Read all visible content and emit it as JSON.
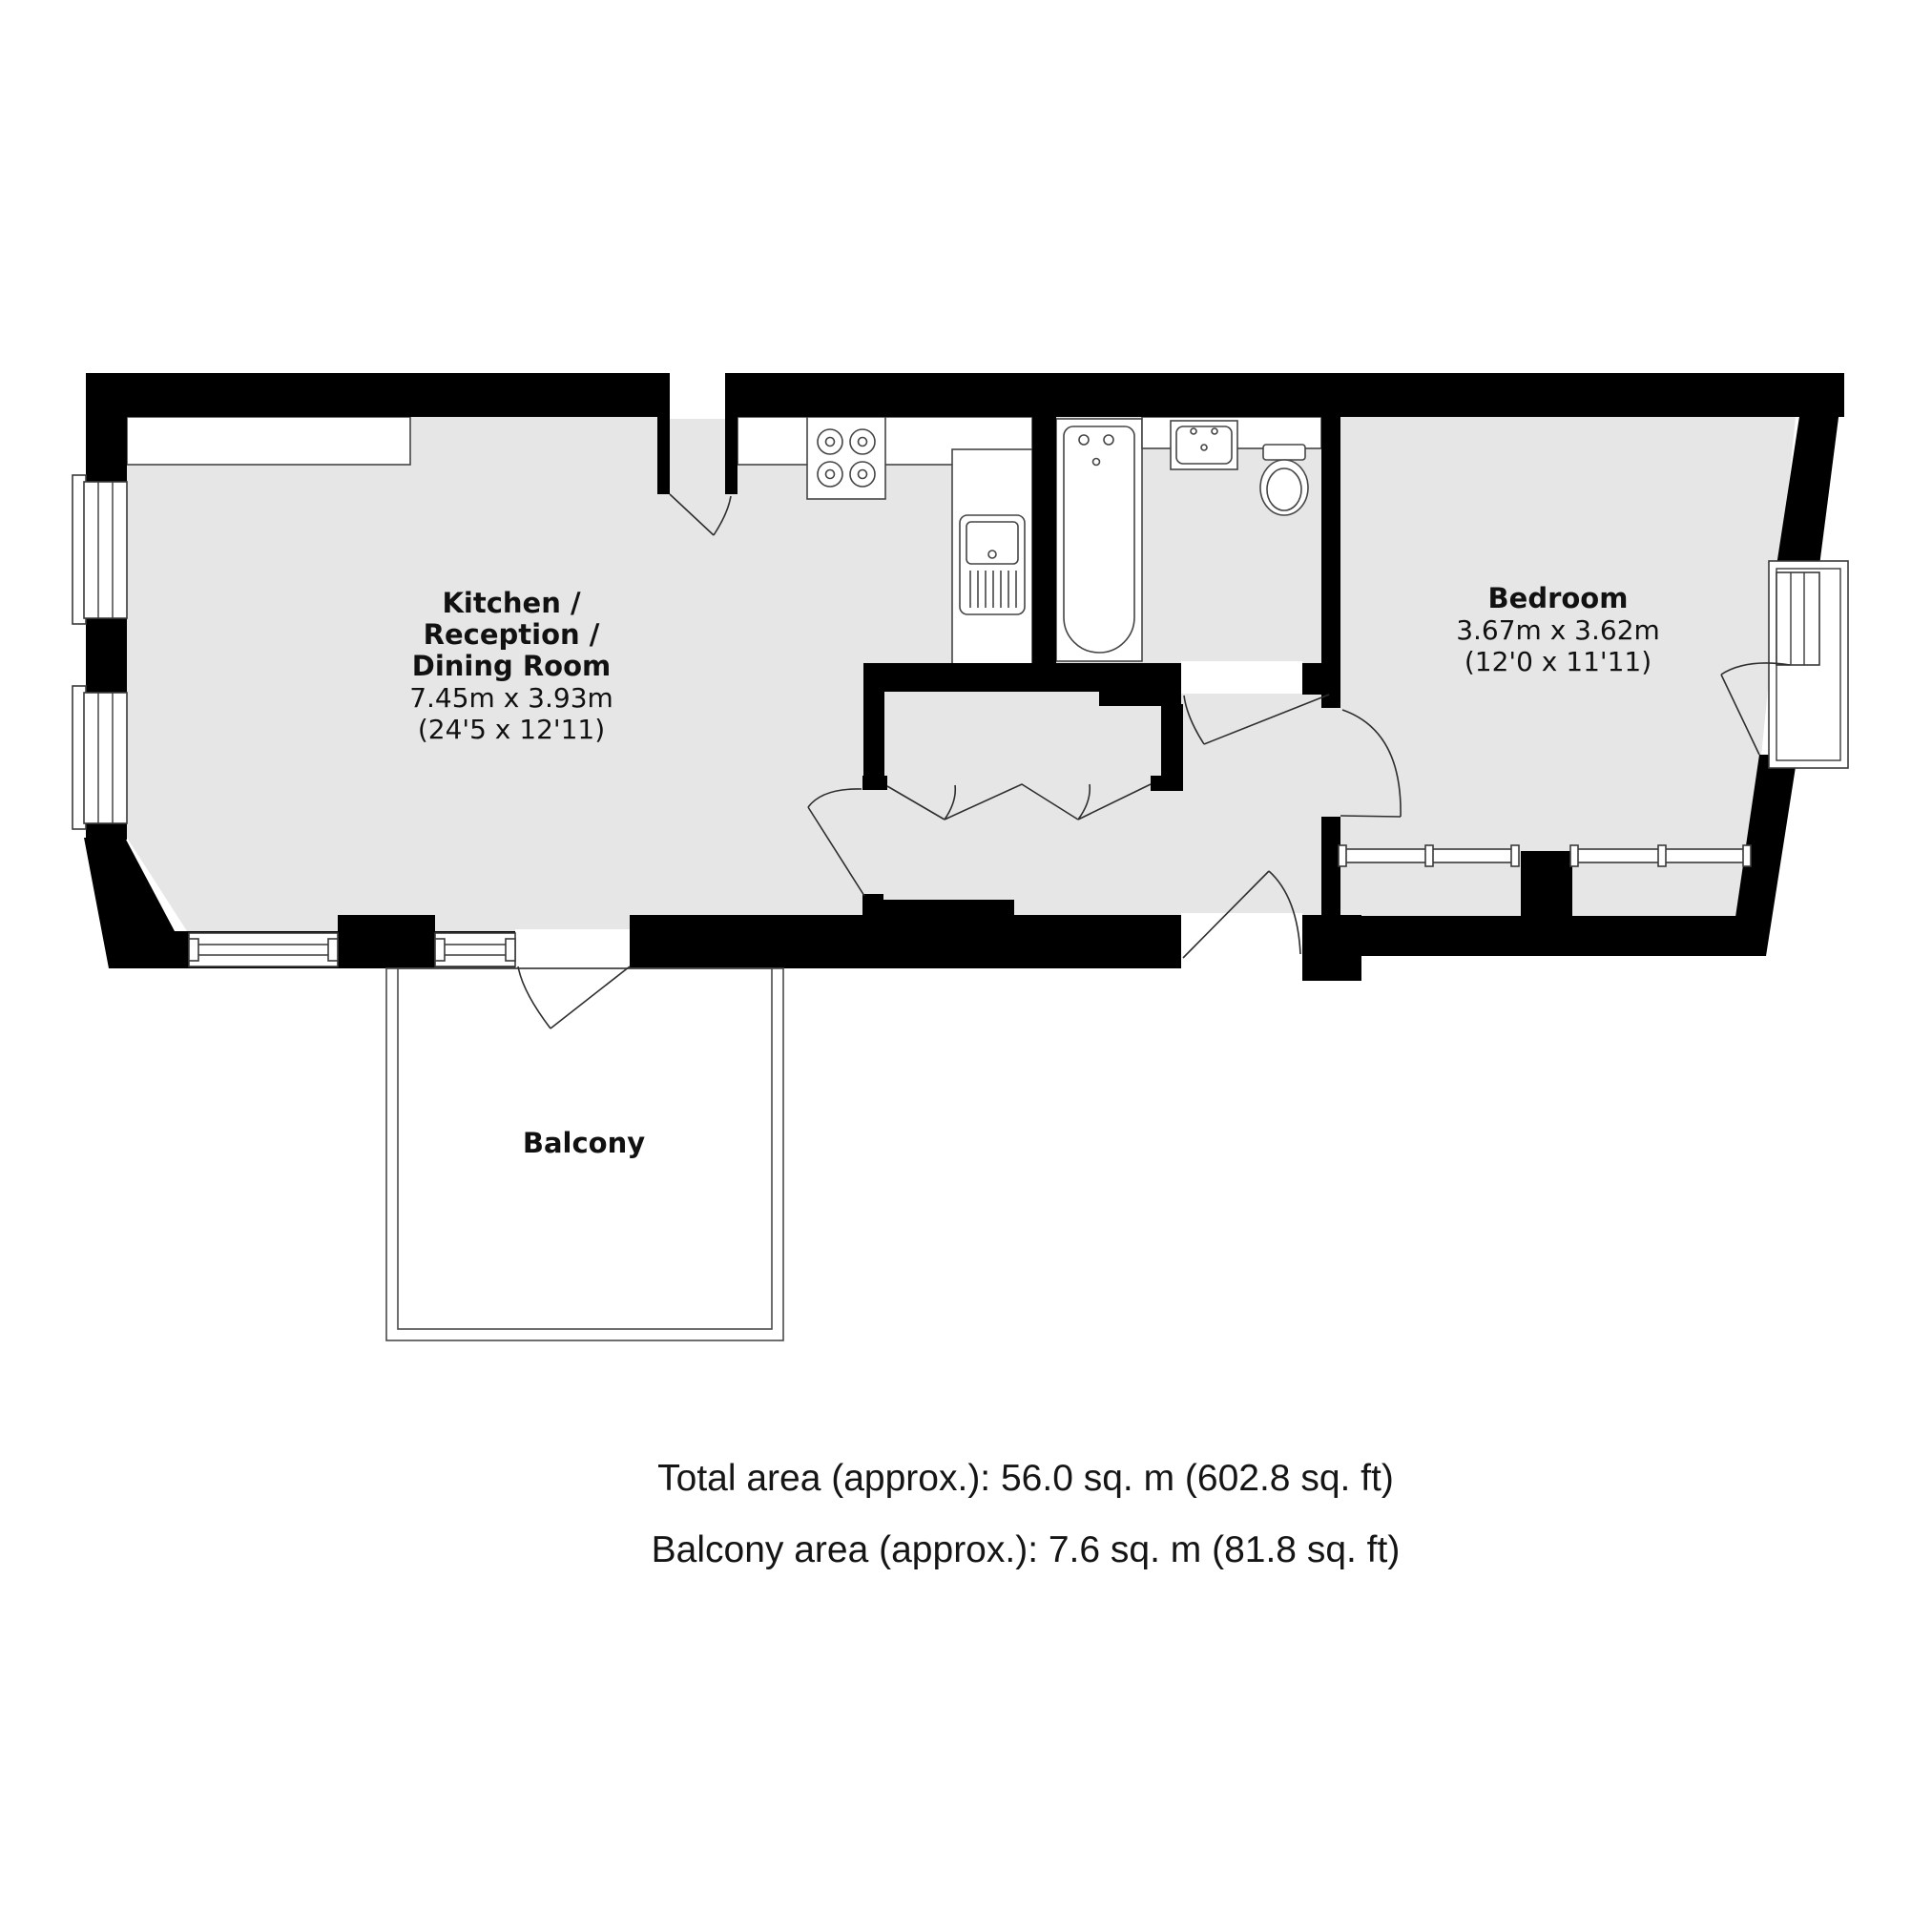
{
  "floorplan": {
    "colors": {
      "wall": "#000000",
      "floor": "#e6e6e6",
      "fixture_outline": "#454545",
      "label_text": "#111111"
    },
    "rooms": {
      "kitchen": {
        "name_line1": "Kitchen /",
        "name_line2": "Reception /",
        "name_line3": "Dining Room",
        "dims_metric": "7.45m x 3.93m",
        "dims_imperial": "(24'5 x 12'11)"
      },
      "bedroom": {
        "name": "Bedroom",
        "dims_metric": "3.67m x 3.62m",
        "dims_imperial": "(12'0 x 11'11)"
      },
      "balcony": {
        "name": "Balcony"
      }
    },
    "fixtures": {
      "stove": "stove-4-burners",
      "kitchen_sink": "kitchen-sink-with-drainer",
      "bathtub": "bathtub",
      "wash_basin": "wash-basin",
      "toilet": "toilet"
    },
    "footer": {
      "total_area": "Total area (approx.): 56.0 sq. m (602.8 sq. ft)",
      "balcony_area": "Balcony area (approx.): 7.6 sq. m (81.8 sq. ft)"
    }
  }
}
